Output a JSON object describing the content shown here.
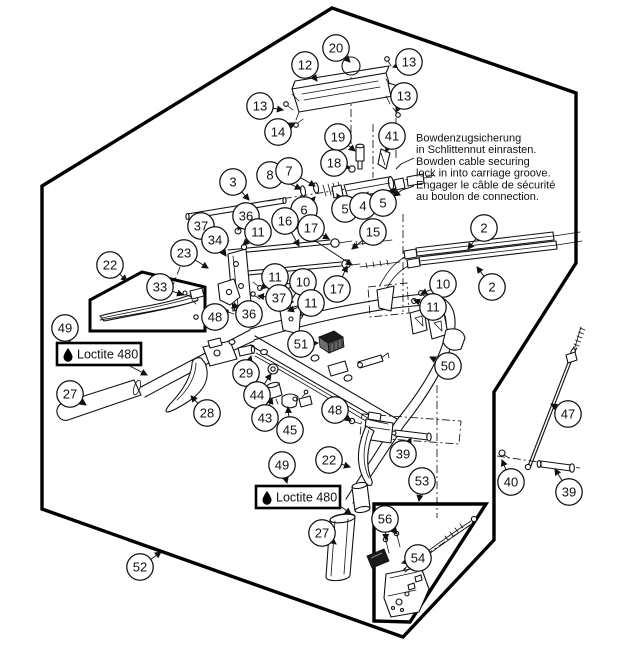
{
  "diagram": {
    "background": "#ffffff",
    "line_color": "#111111",
    "note": {
      "lines": [
        "Bowdenzugsicherung",
        "in Schlittennut einrasten.",
        "Bowden cable securing",
        "lock in into carriage groove.",
        "Engager le câble de sécurité",
        "au boulon de connection."
      ]
    },
    "loctite_labels": [
      {
        "text": "Loctite 480",
        "x": 57,
        "y": 343
      },
      {
        "text": "Loctite 480",
        "x": 256,
        "y": 486
      }
    ],
    "callouts": [
      {
        "n": "20",
        "c": [
          336,
          48
        ],
        "t": [
          [
            350,
            62
          ]
        ]
      },
      {
        "n": "12",
        "c": [
          305,
          65
        ],
        "t": [
          [
            317,
            81
          ]
        ]
      },
      {
        "n": "13",
        "c": [
          409,
          62
        ],
        "t": [
          [
            393,
            67
          ]
        ]
      },
      {
        "n": "13",
        "c": [
          260,
          106
        ],
        "t": [
          [
            283,
            110
          ]
        ]
      },
      {
        "n": "13",
        "c": [
          404,
          96
        ],
        "t": [
          [
            396,
            112
          ]
        ]
      },
      {
        "n": "14",
        "c": [
          278,
          132
        ],
        "t": [
          [
            295,
            123
          ]
        ]
      },
      {
        "n": "19",
        "c": [
          338,
          137
        ],
        "t": [
          [
            355,
            151
          ]
        ]
      },
      {
        "n": "41",
        "c": [
          392,
          136
        ],
        "t": [
          [
            386,
            152
          ]
        ]
      },
      {
        "n": "18",
        "c": [
          334,
          163
        ],
        "t": [
          [
            350,
            168
          ]
        ]
      },
      {
        "n": "8",
        "c": [
          270,
          175
        ],
        "t": [
          [
            301,
            189
          ]
        ]
      },
      {
        "n": "7",
        "c": [
          289,
          171
        ],
        "t": [
          [
            315,
            186
          ]
        ]
      },
      {
        "n": "3",
        "c": [
          233,
          182
        ],
        "t": [
          [
            249,
            200
          ]
        ]
      },
      {
        "n": "6",
        "c": [
          304,
          210
        ],
        "t": [
          [
            315,
            197
          ]
        ]
      },
      {
        "n": "5",
        "c": [
          345,
          209
        ],
        "t": [
          [
            337,
            194
          ]
        ]
      },
      {
        "n": "4",
        "c": [
          363,
          206
        ],
        "t": [
          [
            368,
            192
          ]
        ]
      },
      {
        "n": "5",
        "c": [
          383,
          203
        ],
        "t": [
          [
            396,
            188
          ]
        ]
      },
      {
        "n": "16",
        "c": [
          285,
          221
        ],
        "t": [
          [
            299,
            246
          ],
          [
            352,
            265
          ]
        ]
      },
      {
        "n": "17",
        "c": [
          311,
          228
        ],
        "t": [
          [
            329,
            239
          ]
        ]
      },
      {
        "n": "15",
        "c": [
          373,
          232
        ],
        "t": [
          [
            352,
            249
          ]
        ]
      },
      {
        "n": "36",
        "c": [
          246,
          216
        ],
        "t": [
          [
            238,
            230
          ]
        ]
      },
      {
        "n": "37",
        "c": [
          201,
          226
        ],
        "t": [
          [
            220,
            234
          ]
        ]
      },
      {
        "n": "11",
        "c": [
          258,
          232
        ],
        "t": [
          [
            243,
            245
          ]
        ]
      },
      {
        "n": "34",
        "c": [
          215,
          240
        ],
        "t": [
          [
            226,
            256
          ]
        ]
      },
      {
        "n": "23",
        "c": [
          184,
          253
        ],
        "t": [
          [
            208,
            268
          ]
        ]
      },
      {
        "n": "2",
        "c": [
          484,
          228
        ],
        "t": [
          [
            468,
            249
          ]
        ]
      },
      {
        "n": "2",
        "c": [
          492,
          287
        ],
        "t": [
          [
            477,
            267
          ]
        ]
      },
      {
        "n": "17",
        "c": [
          337,
          289
        ],
        "t": [
          [
            347,
            266
          ]
        ]
      },
      {
        "n": "10",
        "c": [
          443,
          284
        ],
        "t": [
          [
            421,
            294
          ]
        ]
      },
      {
        "n": "11",
        "c": [
          433,
          307
        ],
        "t": [
          [
            414,
            300
          ]
        ]
      },
      {
        "n": "22",
        "c": [
          110,
          265
        ],
        "t": [
          [
            127,
            281
          ]
        ]
      },
      {
        "n": "33",
        "c": [
          160,
          287
        ],
        "t": [
          [
            183,
            295
          ]
        ]
      },
      {
        "n": "11",
        "c": [
          275,
          277
        ],
        "t": [
          [
            261,
            289
          ]
        ]
      },
      {
        "n": "10",
        "c": [
          303,
          282
        ],
        "t": [
          [
            288,
            305
          ]
        ]
      },
      {
        "n": "37",
        "c": [
          279,
          298
        ],
        "t": [
          [
            258,
            296
          ]
        ]
      },
      {
        "n": "11",
        "c": [
          311,
          303
        ],
        "t": [
          [
            288,
            311
          ]
        ]
      },
      {
        "n": "36",
        "c": [
          249,
          314
        ],
        "t": [
          [
            238,
            308
          ]
        ]
      },
      {
        "n": "48",
        "c": [
          215,
          317
        ],
        "t": [
          [
            228,
            311
          ]
        ]
      },
      {
        "n": "49",
        "c": [
          65,
          328
        ],
        "t": [
          [
            70,
            342
          ]
        ]
      },
      {
        "n": "51",
        "c": [
          301,
          344
        ],
        "t": [
          [
            318,
            343
          ]
        ]
      },
      {
        "n": "29",
        "c": [
          246,
          373
        ],
        "t": [
          [
            251,
            356
          ]
        ]
      },
      {
        "n": "27",
        "c": [
          70,
          394
        ],
        "t": [
          [
            86,
            405
          ]
        ]
      },
      {
        "n": "44",
        "c": [
          257,
          395
        ],
        "t": [
          [
            271,
            374
          ]
        ]
      },
      {
        "n": "28",
        "c": [
          207,
          413
        ],
        "t": [
          [
            191,
            396
          ]
        ]
      },
      {
        "n": "43",
        "c": [
          265,
          418
        ],
        "t": [
          [
            272,
            398
          ]
        ]
      },
      {
        "n": "45",
        "c": [
          290,
          430
        ],
        "t": [
          [
            288,
            407
          ]
        ]
      },
      {
        "n": "50",
        "c": [
          448,
          366
        ],
        "t": [
          [
            430,
            357
          ]
        ]
      },
      {
        "n": "48",
        "c": [
          335,
          410
        ],
        "t": [
          [
            351,
            421
          ]
        ]
      },
      {
        "n": "39",
        "c": [
          403,
          454
        ],
        "t": [
          [
            411,
            438
          ]
        ]
      },
      {
        "n": "22",
        "c": [
          329,
          460
        ],
        "t": [
          [
            350,
            467
          ]
        ]
      },
      {
        "n": "49",
        "c": [
          282,
          465
        ],
        "t": [
          [
            287,
            483
          ]
        ]
      },
      {
        "n": "27",
        "c": [
          322,
          533
        ],
        "t": [
          [
            336,
            544
          ]
        ]
      },
      {
        "n": "53",
        "c": [
          422,
          481
        ],
        "t": [
          [
            419,
            501
          ]
        ]
      },
      {
        "n": "56",
        "c": [
          385,
          519
        ],
        "t": [
          [
            386,
            540
          ],
          [
            397,
            534
          ]
        ]
      },
      {
        "n": "54",
        "c": [
          418,
          558
        ],
        "t": [
          [
            402,
            563
          ]
        ]
      },
      {
        "n": "52",
        "c": [
          140,
          567
        ],
        "t": [
          [
            161,
            552
          ]
        ]
      },
      {
        "n": "47",
        "c": [
          568,
          414
        ],
        "t": [
          [
            551,
            404
          ]
        ]
      },
      {
        "n": "40",
        "c": [
          511,
          482
        ],
        "t": [
          [
            502,
            460
          ]
        ]
      },
      {
        "n": "39",
        "c": [
          569,
          492
        ],
        "t": [
          [
            555,
            469
          ]
        ]
      }
    ]
  }
}
